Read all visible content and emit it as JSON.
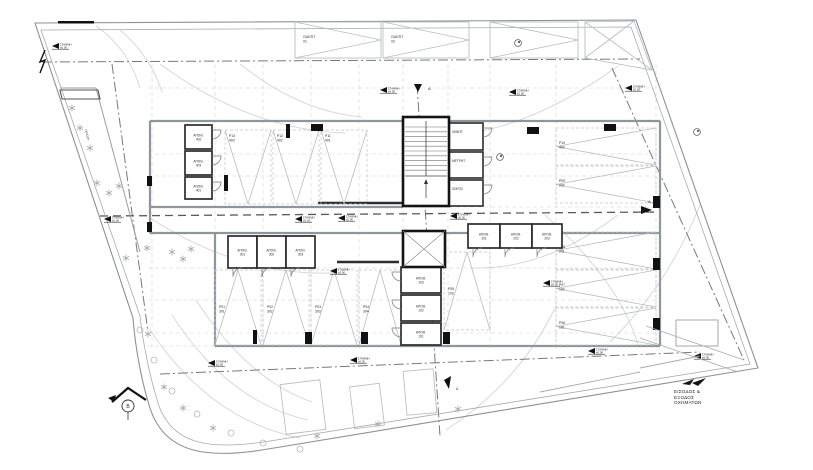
{
  "drawing": {
    "background": "#ffffff",
    "colors": {
      "boundary": "#8e9193",
      "boundary_inner": "#a8abad",
      "wall_grey": "#90959a",
      "wall_dark": "#141414",
      "room_wall": "#2b2b2b",
      "grid": "#cdd0d2",
      "axis_dashdot": "#77797b",
      "axis_heavy": "#585a5c",
      "bay_line": "#c2c5c7",
      "hatch": "#b9bcbe",
      "arc": "#d3d5d7",
      "tree": "#a9aca9",
      "text": "#2b2b2b",
      "black": "#111111"
    },
    "entrance_note": {
      "line1": "ΕΙΣΟΔΟΣ &",
      "line2": "ΕΞΟΔΟΣ",
      "line3": "ΟΧΗΜΑΤΩΝ"
    },
    "planter_label": "ΠΡΑΣΙΑ",
    "level_marker_text": {
      "line1": "ΣΤΑΘΜΗ",
      "line2": "±0.00"
    },
    "level_markers": [
      [
        52,
        46
      ],
      [
        380,
        90
      ],
      [
        509,
        92
      ],
      [
        625,
        88
      ],
      [
        104,
        219
      ],
      [
        295,
        219
      ],
      [
        338,
        218
      ],
      [
        450,
        216
      ],
      [
        543,
        283
      ],
      [
        330,
        271
      ],
      [
        350,
        360
      ],
      [
        208,
        363
      ],
      [
        588,
        351
      ],
      [
        694,
        356
      ]
    ],
    "section_markers": [
      {
        "letter": "A",
        "x": 428,
        "y": 90,
        "kind": "top"
      },
      {
        "letter": "A",
        "x": 648,
        "y": 206,
        "kind": "mid"
      },
      {
        "letter": "A",
        "x": 456,
        "y": 390,
        "kind": "bottom"
      },
      {
        "letter": "B",
        "x": 128,
        "y": 399,
        "kind": "house"
      }
    ],
    "guest_spots": [
      {
        "line1": "GUEST",
        "line2": "01",
        "x": 295,
        "y": 22,
        "w": 86,
        "h": 36
      },
      {
        "line1": "GUEST",
        "line2": "02",
        "x": 383,
        "y": 22,
        "w": 86,
        "h": 36
      }
    ],
    "accessible_spot": {
      "x": 490,
      "y": 22,
      "w": 88,
      "h": 36
    },
    "corner_spot_points": "585,22 634,21 652,70 585,58",
    "parking_spots": [
      {
        "id": "P13",
        "num": "403",
        "x": 225,
        "y": 130,
        "w": 46,
        "h": 74,
        "dir": "s"
      },
      {
        "id": "P12",
        "num": "402",
        "x": 273,
        "y": 130,
        "w": 46,
        "h": 74,
        "dir": "s"
      },
      {
        "id": "P11",
        "num": "401",
        "x": 321,
        "y": 130,
        "w": 46,
        "h": 74,
        "dir": "s"
      },
      {
        "id": "P01",
        "num": "301",
        "x": 215,
        "y": 270,
        "w": 46,
        "h": 75,
        "dir": "n"
      },
      {
        "id": "P02",
        "num": "302",
        "x": 263,
        "y": 270,
        "w": 46,
        "h": 75,
        "dir": "n"
      },
      {
        "id": "P03",
        "num": "303",
        "x": 311,
        "y": 270,
        "w": 46,
        "h": 75,
        "dir": "n"
      },
      {
        "id": "P04",
        "num": "304",
        "x": 359,
        "y": 270,
        "w": 42,
        "h": 75,
        "dir": "n"
      },
      {
        "id": "P05",
        "num": "103",
        "x": 444,
        "y": 252,
        "w": 46,
        "h": 78,
        "dir": "n"
      },
      {
        "id": "P10",
        "num": "400",
        "x": 556,
        "y": 128,
        "w": 100,
        "h": 37,
        "dir": "w"
      },
      {
        "id": "P09",
        "num": "202",
        "x": 556,
        "y": 166,
        "w": 100,
        "h": 37,
        "dir": "w"
      },
      {
        "id": "P08",
        "num": "201",
        "x": 556,
        "y": 232,
        "w": 100,
        "h": 37,
        "dir": "w"
      },
      {
        "id": "P07",
        "num": "102",
        "x": 556,
        "y": 270,
        "w": 100,
        "h": 37,
        "dir": "w"
      },
      {
        "id": "P06",
        "num": "101",
        "x": 556,
        "y": 308,
        "w": 100,
        "h": 37,
        "dir": "w"
      }
    ],
    "storage_label": "ΑΠΟΘ.",
    "storage_rooms": [
      {
        "num": "402",
        "x": 185,
        "y": 125,
        "w": 27,
        "h": 24,
        "door": "e"
      },
      {
        "num": "403",
        "x": 185,
        "y": 151,
        "w": 27,
        "h": 24,
        "door": "e"
      },
      {
        "num": "401",
        "x": 185,
        "y": 177,
        "w": 27,
        "h": 22,
        "door": "e"
      },
      {
        "num": "301",
        "x": 228,
        "y": 236,
        "w": 29,
        "h": 32,
        "door": "s"
      },
      {
        "num": "302",
        "x": 257,
        "y": 236,
        "w": 29,
        "h": 32,
        "door": "s"
      },
      {
        "num": "303",
        "x": 286,
        "y": 236,
        "w": 29,
        "h": 32,
        "door": "s"
      },
      {
        "num": "201",
        "x": 468,
        "y": 224,
        "w": 32,
        "h": 24,
        "door": "s"
      },
      {
        "num": "202",
        "x": 500,
        "y": 224,
        "w": 32,
        "h": 24,
        "door": "s"
      },
      {
        "num": "203",
        "x": 532,
        "y": 224,
        "w": 30,
        "h": 24,
        "door": "s"
      },
      {
        "num": "103",
        "x": 401,
        "y": 267,
        "w": 40,
        "h": 26,
        "door": "w"
      },
      {
        "num": "102",
        "x": 401,
        "y": 295,
        "w": 40,
        "h": 26,
        "door": "w"
      },
      {
        "num": "101",
        "x": 401,
        "y": 323,
        "w": 40,
        "h": 22,
        "door": "w"
      }
    ],
    "utility_rooms": [
      {
        "label": "ΛΕΒΗΤ.",
        "x": 449,
        "y": 123,
        "w": 34,
        "h": 27
      },
      {
        "label": "ΜΕΤΡΗΤ.",
        "x": 449,
        "y": 152,
        "w": 34,
        "h": 26
      },
      {
        "label": "ΧΩΡΟΣ",
        "x": 449,
        "y": 180,
        "w": 34,
        "h": 26
      }
    ],
    "geometry": {
      "boundary_outer": "M 35 23 L 636 20 L 758 368 L 268 449 C 210 459 165 455 150 408 C 141 380 135 345 133 318 Z",
      "boundary_inner": "M 41 30 L 631 27 L 750 364 L 270 441 C 214 450 172 447 158 403 C 150 377 143 344 140 316 Z",
      "axes_dashdot": [
        "M 42 62 L 640 59",
        "M 417 84 L 440 436",
        "M 612 68 L 744 360",
        "M 160 374 L 700 352",
        "M 112 64 L 148 332"
      ],
      "axis_heavy": "M 100 216 L 660 212",
      "grid_v": [
        152,
        215,
        263,
        311,
        359,
        403,
        448,
        490,
        556,
        656
      ],
      "grid_h": [
        88,
        121,
        154,
        176,
        207,
        233,
        268,
        300,
        333,
        346
      ],
      "walls_grey": [
        "M150 121 H403",
        "M449 121 H660",
        "M150 121 V233",
        "M660 121 V346",
        "M150 207 H403",
        "M150 233 H660",
        "M215 233 V346",
        "M215 346 H660"
      ],
      "walls_dark": [
        "M318 203 H405",
        "M337 262 H399"
      ],
      "sweep_arcs": [
        "M160 64 Q250 130 345 133",
        "M618 66 Q520 137 432 136",
        "M240 64 Q300 112 362 117",
        "M150 218 Q240 276 332 273",
        "M618 215 Q545 270 472 268",
        "M150 330 Q210 420 300 438",
        "M172 315 Q228 402 308 420",
        "M196 300 Q248 380 312 402",
        "M545 215 Q620 282 638 345",
        "M700 205 Q668 285 610 342",
        "M446 430 Q520 382 556 306",
        "M120 30 Q150 55 162 92",
        "M96 26 Q128 48 140 88"
      ],
      "planter_lines": [
        "M 96 88 L 140 252",
        "M 60 88 L 96 88"
      ],
      "planter_box": "60,90 98,90 100,99 62,99",
      "columns": [
        [
          311,
          124,
          12,
          7
        ],
        [
          527,
          127,
          12,
          7
        ],
        [
          604,
          124,
          12,
          7
        ],
        [
          653,
          196,
          7,
          12
        ],
        [
          653,
          258,
          7,
          12
        ],
        [
          653,
          318,
          7,
          12
        ],
        [
          224,
          175,
          4,
          16
        ],
        [
          286,
          124,
          4,
          14
        ],
        [
          305,
          332,
          7,
          12
        ],
        [
          361,
          332,
          7,
          12
        ],
        [
          253,
          330,
          4,
          14
        ],
        [
          147,
          176,
          5,
          10
        ],
        [
          147,
          222,
          5,
          10
        ],
        [
          443,
          332,
          7,
          12
        ]
      ],
      "top_wall_bar": [
        58,
        21,
        36,
        2.5
      ],
      "flash_path": "M45 50 L40 62 L45 60 L40 73",
      "trees": [
        [
          97,
          183
        ],
        [
          109,
          193
        ],
        [
          119,
          186
        ],
        [
          126,
          258
        ],
        [
          147,
          248
        ],
        [
          172,
          252
        ],
        [
          183,
          259
        ],
        [
          191,
          249
        ],
        [
          148,
          334
        ],
        [
          164,
          387
        ],
        [
          183,
          408
        ],
        [
          213,
          428
        ],
        [
          317,
          436
        ],
        [
          378,
          424
        ],
        [
          458,
          409
        ],
        [
          72,
          108
        ],
        [
          80,
          128
        ],
        [
          90,
          148
        ]
      ],
      "shrubs": [
        [
          140,
          330
        ],
        [
          154,
          360
        ],
        [
          172,
          391
        ],
        [
          197,
          414
        ],
        [
          231,
          433
        ],
        [
          263,
          443
        ],
        [
          300,
          449
        ]
      ],
      "exterior_bays": [
        [
          283,
          382,
          40,
          50,
          -7
        ],
        [
          352,
          385,
          30,
          42,
          -7
        ],
        [
          405,
          370,
          30,
          44,
          -5
        ]
      ],
      "symbol_circles": [
        [
          697,
          132
        ],
        [
          500,
          157
        ],
        [
          518,
          43
        ]
      ],
      "ramp": {
        "rect": [
          676,
          320,
          42,
          26
        ],
        "lines": [
          "M640 338 L738 372",
          "M646 326 L744 360",
          "M540 392 L640 372 M640 368 L700 356"
        ],
        "arrows": [
          "682,384 694,379 690,385",
          "692,383 706,378 698,386"
        ]
      },
      "stair": {
        "x": 403,
        "y": 117,
        "w": 46,
        "h": 89,
        "steps_top": 127,
        "steps_bottom": 175,
        "step": 4.8,
        "landing_y": 176
      },
      "elevator": {
        "x": 403,
        "y": 231,
        "w": 42,
        "h": 36
      }
    }
  }
}
